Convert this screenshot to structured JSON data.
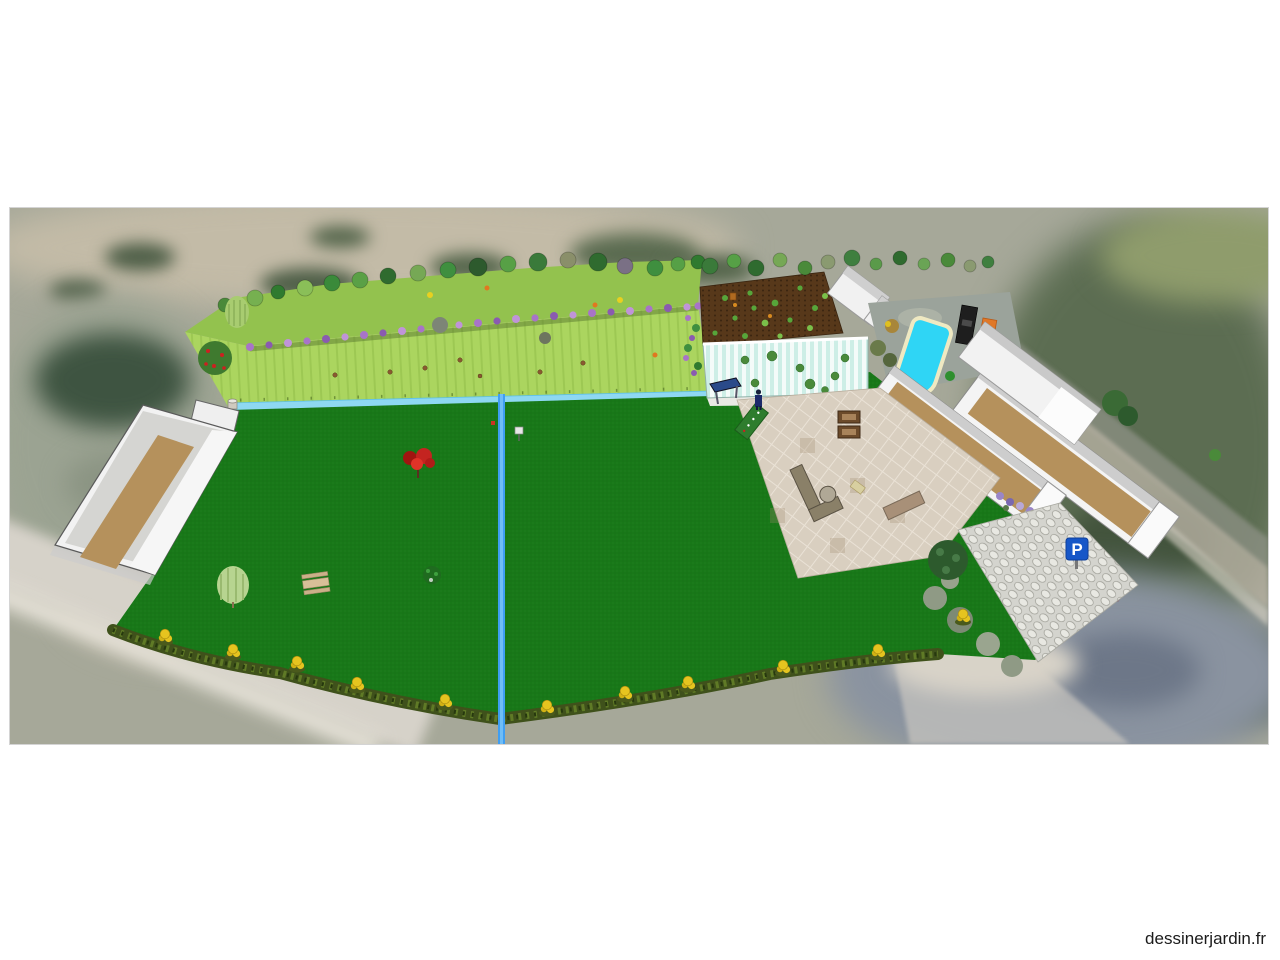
{
  "watermark": {
    "text": "dessinerjardin.fr"
  },
  "scene": {
    "label": "3D garden plan rendered over aerial photo",
    "parking_sign": {
      "letter": "P"
    },
    "colors": {
      "lawn": "#187818",
      "hillside_upper": "#93c24e",
      "hillside_lower": "#abd55f",
      "stream": "#8ed8f2",
      "stream_channel": "#3f9ef2",
      "pool_water": "#2fd5f5",
      "pool_border": "#efe9c2",
      "vegetable_soil": "#57381a",
      "building_wall": "#f2f2f2",
      "roof_tan": "#b5915c",
      "tiles": "#d9cfc0",
      "cobbles": "#d4d4ce",
      "hedge": "#3f511b",
      "yellow_bush": "#e6c41f",
      "lavender": "#a874c8",
      "red_tree": "#c42420",
      "person": "#1c2a6a",
      "parking_sign_bg": "#1757c8",
      "greenhouse_stripe": "#cdeee6"
    }
  }
}
